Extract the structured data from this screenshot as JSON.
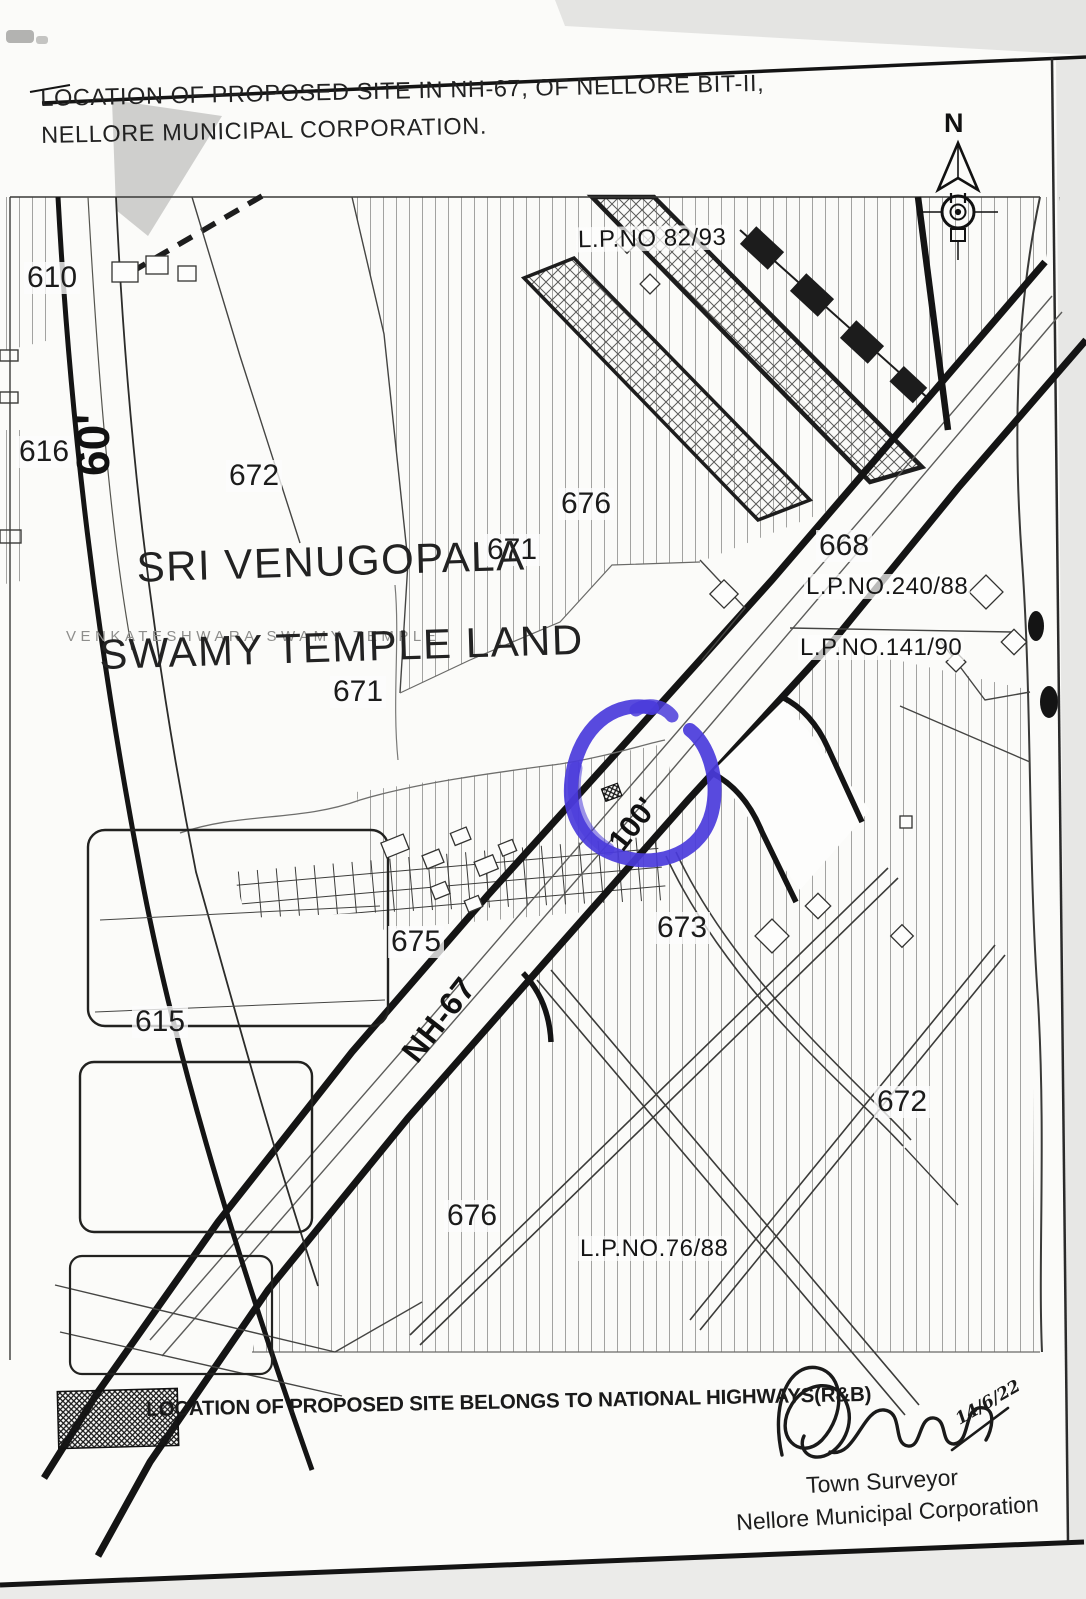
{
  "header": {
    "title_line1": "LOCATION OF PROPOSED SITE IN NH-67, OF NELLORE BIT-II,",
    "title_line2": "NELLORE MUNICIPAL CORPORATION."
  },
  "compass": {
    "north_label": "N"
  },
  "map": {
    "plot_labels": [
      {
        "text": "610"
      },
      {
        "text": "616"
      },
      {
        "text": "672"
      },
      {
        "text": "676"
      },
      {
        "text": "671"
      },
      {
        "text": "668"
      },
      {
        "text": "671"
      },
      {
        "text": "675"
      },
      {
        "text": "615"
      },
      {
        "text": "673"
      },
      {
        "text": "672"
      },
      {
        "text": "676"
      }
    ],
    "lp_labels": [
      {
        "text": "L.P.NO 82/93"
      },
      {
        "text": "L.P.NO.240/88"
      },
      {
        "text": "L.P.NO.141/90"
      },
      {
        "text": "L.P.NO.76/88"
      }
    ],
    "road_labels": {
      "road_60": "60'",
      "nh67": "NH-67",
      "width_100": "100'"
    },
    "temple_label": {
      "line1": "SRI VENUGOPALA",
      "line2": "SWAMY TEMPLE LAND",
      "underlay": "VENKATESHWARA SWAMY TEMPLE"
    }
  },
  "legend": {
    "text": "LOCATION OF PROPOSED SITE BELONGS TO NATIONAL HIGHWAYS(R&B)"
  },
  "signature": {
    "date": "14/6/22",
    "title": "Town Surveyor",
    "org": "Nellore Municipal Corporation"
  },
  "colors": {
    "highlight_blue": "#4a3bdb",
    "ink": "#1c1c1c",
    "paper": "#fbfbf9"
  }
}
